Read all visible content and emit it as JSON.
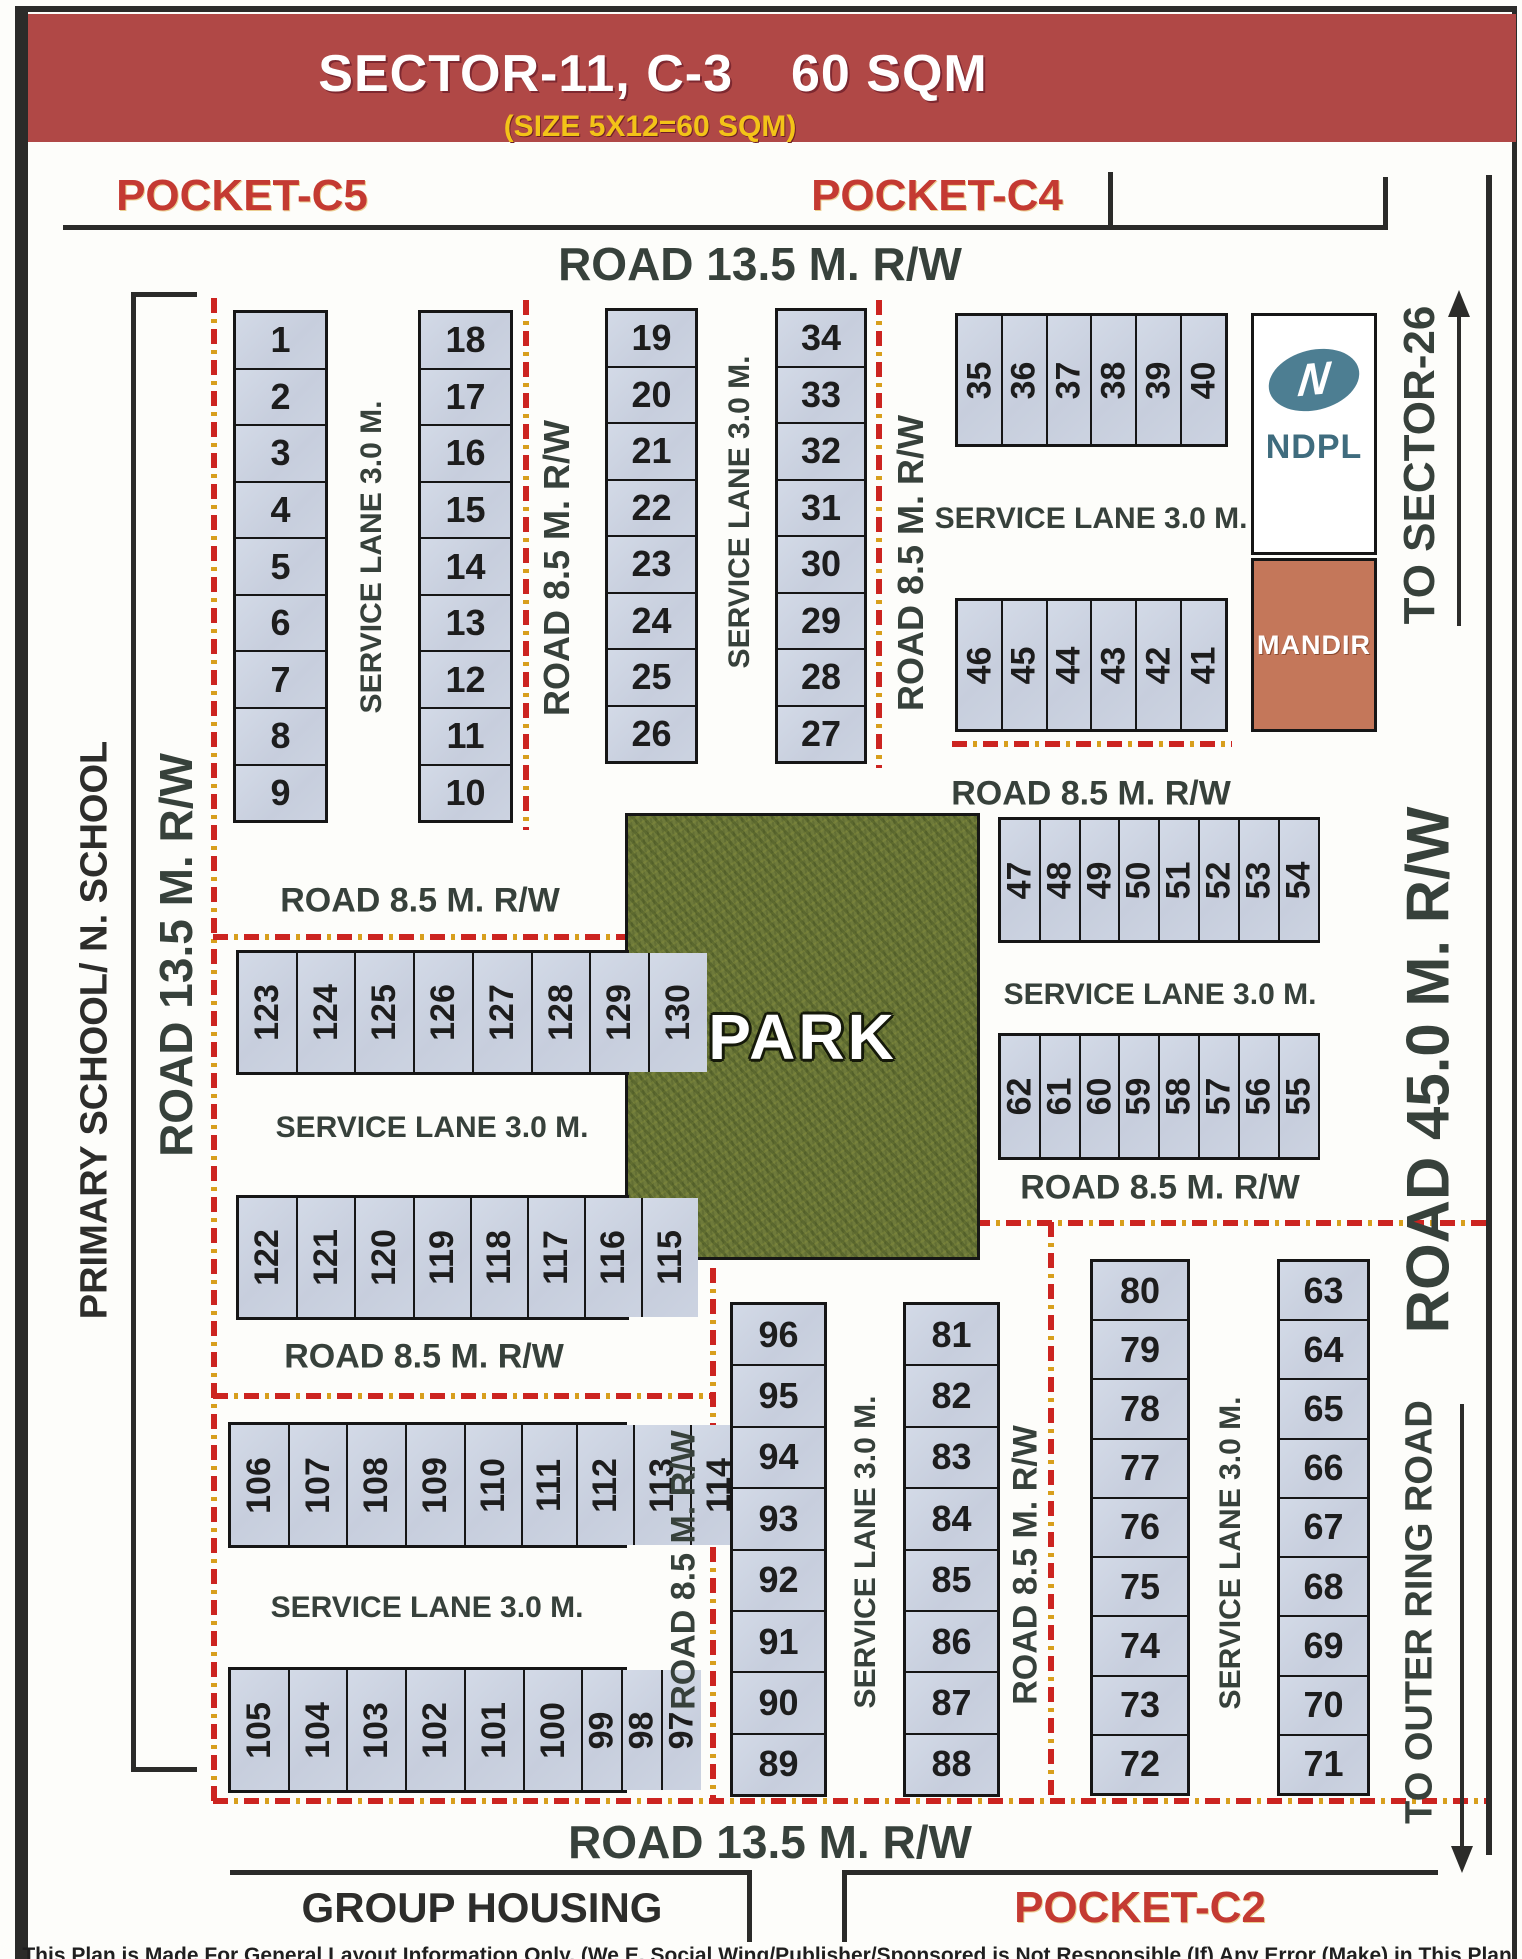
{
  "title": {
    "sector": "SECTOR-11, C-3",
    "size": "60 SQM",
    "subtitle": "(SIZE 5X12=60 SQM)"
  },
  "pockets": {
    "c5": "POCKET-C5",
    "c4": "POCKET-C4",
    "c2": "POCKET-C2"
  },
  "areas": {
    "group_housing": "GROUP HOUSING",
    "primary_school": "PRIMARY SCHOOL/ N. SCHOOL",
    "park": "PARK",
    "ndpl": "NDPL",
    "ndpl_logo_letter": "N",
    "mandir": "MANDIR"
  },
  "roads": {
    "road_135": "ROAD 13.5 M. R/W",
    "road_85": "ROAD 8.5 M. R/W",
    "road_45": "ROAD 45.0 M. R/W",
    "service_lane": "SERVICE LANE 3.0 M.",
    "to_sector_26": "TO SECTOR-26",
    "to_outer_ring": "TO OUTER RING ROAD"
  },
  "plot_blocks": {
    "col_1_9": [
      1,
      2,
      3,
      4,
      5,
      6,
      7,
      8,
      9
    ],
    "col_18_10": [
      18,
      17,
      16,
      15,
      14,
      13,
      12,
      11,
      10
    ],
    "col_19_26": [
      19,
      20,
      21,
      22,
      23,
      24,
      25,
      26
    ],
    "col_34_27": [
      34,
      33,
      32,
      31,
      30,
      29,
      28,
      27
    ],
    "row_35_40": [
      35,
      36,
      37,
      38,
      39,
      40
    ],
    "row_46_41": [
      46,
      45,
      44,
      43,
      42,
      41
    ],
    "row_47_54": [
      47,
      48,
      49,
      50,
      51,
      52,
      53,
      54
    ],
    "row_62_55": [
      62,
      61,
      60,
      59,
      58,
      57,
      56,
      55
    ],
    "row_123_130": [
      123,
      124,
      125,
      126,
      127,
      128,
      129,
      130
    ],
    "row_122_115": [
      122,
      121,
      120,
      119,
      118,
      117,
      116,
      115
    ],
    "row_106_114": [
      106,
      107,
      108,
      109,
      110,
      111,
      112,
      113,
      114
    ],
    "row_105_97": [
      105,
      104,
      103,
      102,
      101,
      100,
      99,
      98,
      97
    ],
    "col_96_89": [
      96,
      95,
      94,
      93,
      92,
      91,
      90,
      89
    ],
    "col_81_88": [
      81,
      82,
      83,
      84,
      85,
      86,
      87,
      88
    ],
    "col_80_72": [
      80,
      79,
      78,
      77,
      76,
      75,
      74,
      73,
      72
    ],
    "col_63_71": [
      63,
      64,
      65,
      66,
      67,
      68,
      69,
      70,
      71
    ]
  },
  "footer": {
    "disclaimer": "This Plan is Made For General Layout Information Only. (We E. Social Wing/Publisher/Sponsored is Not Responsible (If) Any Error (Make) in This Plan."
  },
  "colors": {
    "banner_red": "#b04846",
    "subtitle_yellow": "#f3c318",
    "pocket_red": "#c43a32",
    "road_text": "#37413b",
    "plot_fill": "#ccd3e1",
    "park_green": "#6e7a3a",
    "mandir_orange": "#c4775a",
    "ndpl_teal": "#4d7e92",
    "red_line": "#cc2420"
  }
}
